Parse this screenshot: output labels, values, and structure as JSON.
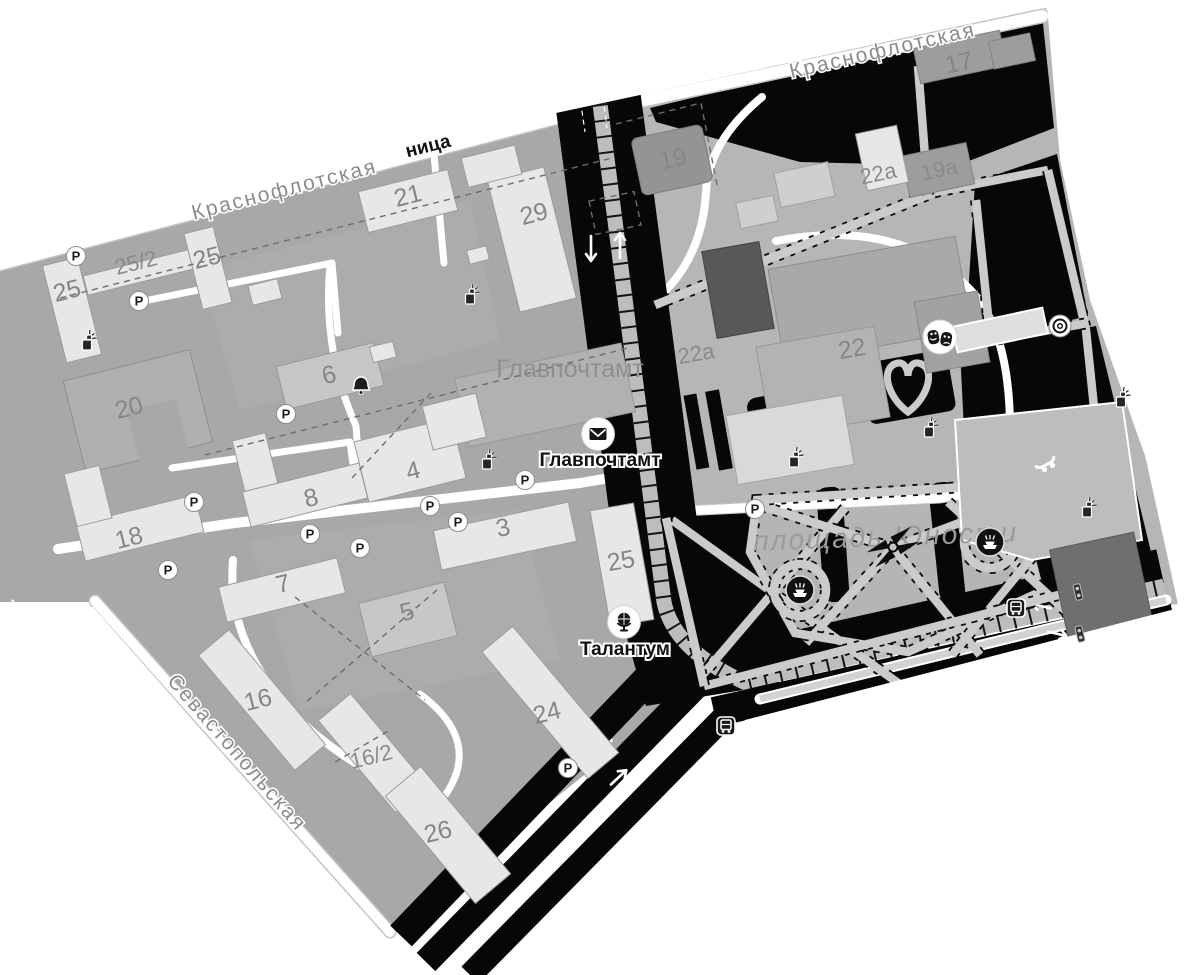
{
  "map": {
    "icons": {
      "parking": "P",
      "mail": "envelope",
      "globe": "globe-on-stand",
      "theater": "comedy-tragedy-masks",
      "fountain": "fountain",
      "bus": "bus",
      "traffic_light": "traffic-light",
      "target": "concentric-rings",
      "skateboard": "skateboard",
      "bell": "bell",
      "waste_bin": "bin-with-sparks",
      "monument": "pinwheel-monument"
    },
    "streets": [
      {
        "name": "Краснофлотская"
      },
      {
        "name": "Краснофлотская"
      },
      {
        "name": "Севастопольская"
      }
    ],
    "area_labels": [
      {
        "text": "Главпочтамт"
      },
      {
        "text": "площадь Юности"
      }
    ],
    "poi": [
      {
        "label": "Главпочтамт",
        "icon": "mail"
      },
      {
        "label": "Талантум",
        "icon": "globe"
      },
      {
        "label": "",
        "icon": "theater"
      },
      {
        "label": "ница",
        "icon": "none"
      }
    ],
    "buildings": [
      {
        "label": "25"
      },
      {
        "label": "25/2"
      },
      {
        "label": "25"
      },
      {
        "label": "21"
      },
      {
        "label": "29"
      },
      {
        "label": "19"
      },
      {
        "label": "17"
      },
      {
        "label": "22а"
      },
      {
        "label": "19а"
      },
      {
        "label": "6"
      },
      {
        "label": "20"
      },
      {
        "label": "22а"
      },
      {
        "label": "22"
      },
      {
        "label": "4"
      },
      {
        "label": "8"
      },
      {
        "label": "18"
      },
      {
        "label": "3"
      },
      {
        "label": "7"
      },
      {
        "label": "5"
      },
      {
        "label": "25"
      },
      {
        "label": "16"
      },
      {
        "label": "16/2"
      },
      {
        "label": "24"
      },
      {
        "label": "26"
      }
    ]
  }
}
